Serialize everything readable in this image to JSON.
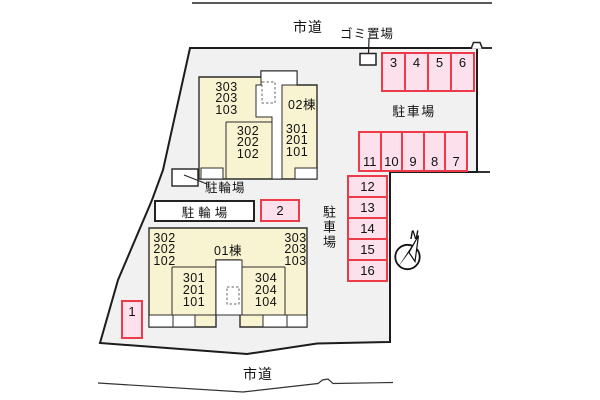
{
  "colors": {
    "site-fill": "#f1f1f1",
    "site-stroke": "#1c1c1c",
    "building-fill": "#f8f3d1",
    "building-stroke": "#2e2e2e",
    "spot-fill": "#fce0eb",
    "spot-border": "#ee3b49",
    "text": "#111111"
  },
  "roads": {
    "top": "市道",
    "bottom": "市道"
  },
  "garbage": {
    "label": "ゴミ置場"
  },
  "parking": {
    "label_top": "駐車場",
    "label_side": "駐車場",
    "row_top": [
      "3",
      "4",
      "5",
      "6"
    ],
    "row_mid": [
      "11",
      "10",
      "9",
      "8",
      "7"
    ],
    "col_left": [
      "12",
      "13",
      "14",
      "15",
      "16"
    ],
    "spot_2": "2",
    "spot_1": "1"
  },
  "bicycle": {
    "label_upper": "駐輪場",
    "label_lower": "駐輪場"
  },
  "buildings": {
    "b02": {
      "name": "02棟",
      "stack_upper": "303\n203\n103",
      "stack_lower_left": "302\n202\n102",
      "stack_lower_right": "301\n201\n101"
    },
    "b01": {
      "name": "01棟",
      "stack_upper_left": "302\n202\n102",
      "stack_upper_right": "303\n203\n103",
      "stack_lower_left": "301\n201\n101",
      "stack_lower_right": "304\n204\n104"
    }
  },
  "compass": {
    "north": "N"
  }
}
